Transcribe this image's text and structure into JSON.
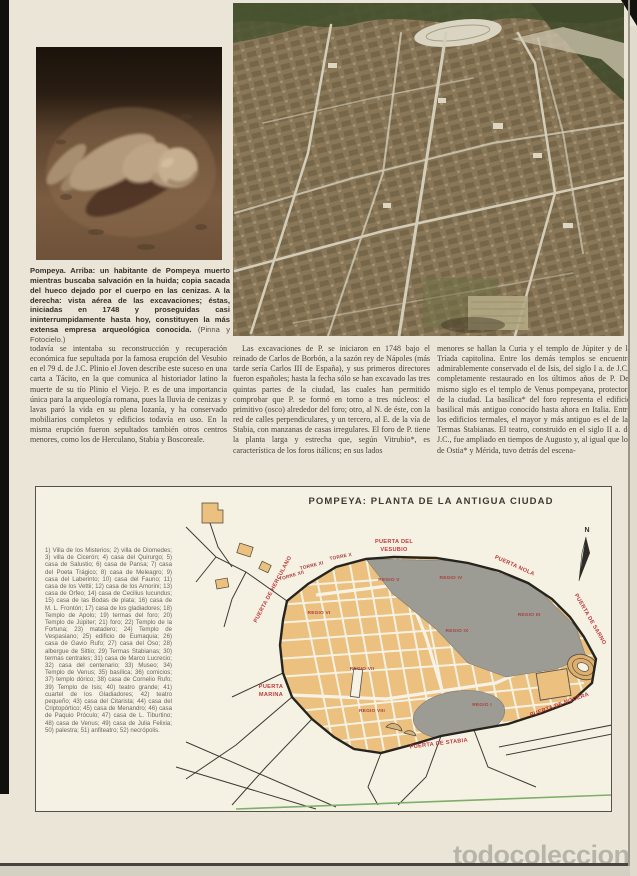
{
  "watermark": "todocoleccion",
  "caption": {
    "text": "Pompeya. Arriba: un habitante de Pompeya muerto mientras buscaba salvación en la huida; copia sacada del hueco dejado por el cuerpo en las cenizas. A la derecha: vista aérea de las excavaciones; éstas, iniciadas en 1748 y proseguidas casi ininterrumpidamente hasta hoy, constituyen la más extensa empresa arqueológica conocida.",
    "credit": "(Pinna y Fotocielo.)"
  },
  "article": {
    "col1": "todavía se intentaba su reconstrucción y recuperación económica fue sepultada por la famosa erupción del Vesubio en el 79 d. de J.C. Plinio el Joven describe este suceso en una carta a Tácito, en la que comunica al historiador latino la muerte de su tío Plinio el Viejo. P. es de una importancia única para la arqueología romana, pues la lluvia de cenizas y lavas paró la vida en su plena lozanía, y ha conservado mobiliarios completos y edificios todavía en uso. En la misma erupción fueron sepultados también otros centros menores, como los de Herculano, Stabia y Boscoreale.",
    "col2": "Las excavaciones de P. se iniciaron en 1748 bajo el reinado de Carlos de Borbón, a la sazón rey de Nápoles (más tarde sería Carlos III de España), y sus primeros directores fueron españoles; hasta la fecha sólo se han excavado las tres quintas partes de la ciudad, las cuales han permitido comprobar que P. se formó en torno a tres núcleos: el primitivo (osco) alrededor del foro; otro, al N. de éste, con la red de calles perpendiculares, y un tercero, al E. de la vía de Stabia, con manzanas de casas irregulares. El foro de P. tiene la planta larga y estrecha que, según Vitrubio*, es característica de los foros itálicos; en sus lados",
    "col3": "menores se hallan la Curia y el templo de Júpiter y de la Tríada capitolina. Entre los demás templos se encuentra admirablemente conservado el de Isis, del siglo I a. de J.C., completamente restaurado en los últimos años de P. Del mismo siglo es el templo de Venus pompeyana, protectora de la ciudad. La basílica* del foro representa el edificio basilical más antiguo conocido hasta ahora en Italia. Entre los edificios termales, el mayor y más antiguo es el de las Termas Stabianas. El teatro, construido en el siglo II a. de J.C., fue ampliado en tiempos de Augusto y, al igual que los de Ostia* y Mérida, tuvo detrás del escena-"
  },
  "map": {
    "title": "POMPEYA: PLANTA DE LA ANTIGUA CIUDAD",
    "legend": "1) Villa de los Misterios; 2) villa de Diomedes; 3) villa de Cicerón; 4) casa del Quirurgo; 5) casa de Salustio; 6) casa de Pansa; 7) casa del Poeta Trágico; 8) casa de Meleagro; 9) casa del Laberinto; 10) casa del Fauno; 11) casa de los Vettii; 12) casa de los Amorini; 13) casa de Orfeo; 14) casa de Cecilius Iucundus; 15) casa de las Bodas de plata; 16) casa de M. L. Frontón; 17) casa de los gladiadores; 18) Templo de Apolo; 19) termas del foro; 20) Templo de Júpiter; 21) foro; 22) Templo de la Fortuna; 23) matadero; 24) Templo de Vespasiano; 25) edificio de Eumaquia; 26) casa de Gavio Rufo; 27) casa del Oso; 28) albergue de Sittio; 29) Termas Stabianas; 30) termas centrales; 31) casa de Marco Lucrecio; 32) casa del centenario; 33) Museo; 34) Templo de Venus; 35) basílica; 36) comicios; 37) templo dórico; 38) casa de Cornelio Rufo; 39) Templo de Isis; 40) teatro grande; 41) cuartel de los Gladiadores; 42) teatro pequeño; 43) casa del Citarista; 44) casa del Criptopórtico; 45) casa de Menandro; 46) casa de Paquio Próculo; 47) casa de L. Tiburtino; 48) casa de Venus; 49) casa de Julia Felixia; 50) palestra; 51) anfiteatro; 52) necrópolis.",
    "labels": {
      "vesubio_line1": "PUERTA DEL",
      "vesubio_line2": "VESUBIO",
      "herculano": "PUERTA DE HERCULANO",
      "nola": "PUERTA NOLA",
      "sarno": "PUERTA DE SARNO",
      "nocera": "PUERTA DE NOCERA",
      "stabia": "PUERTA DE STABIA",
      "marina_line1": "PUERTA",
      "marina_line2": "MARINA",
      "torre_x": "TORRE X",
      "torre_xi": "TORRE XI",
      "torre_xii": "TORRE XII",
      "north": "N"
    },
    "regios": {
      "v": "REGIO V",
      "iv": "REGIO IV",
      "iii": "REGIO III",
      "ix": "REGIO IX",
      "vi": "REGIO VI",
      "vii": "REGIO VII",
      "viii": "REGIO VIII",
      "i": "REGIO I"
    },
    "colors": {
      "blocks": "#ecc07e",
      "unexcavated": "#9d9c94",
      "label_red": "#c0393b",
      "wall": "#26241f"
    }
  }
}
